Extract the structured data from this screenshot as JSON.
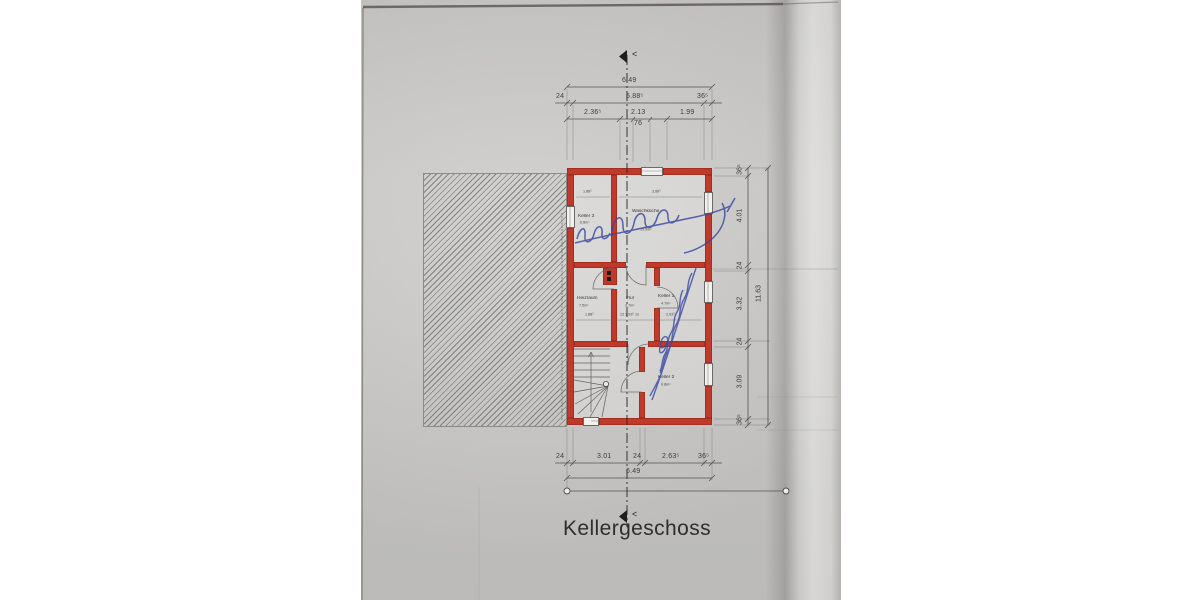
{
  "document": {
    "type": "scanned basement floor plan",
    "title": "Kellergeschoss"
  },
  "rooms": [
    {
      "name": "Keller 3",
      "area": "6.8m²",
      "width_dim": "1.88⁵"
    },
    {
      "name": "Waschküche",
      "area": "15.5m²",
      "width_dim": "3.88⁵"
    },
    {
      "name": "Heizraum",
      "area": "7.5m²",
      "width_dim": "1.88⁵"
    },
    {
      "name": "Flur",
      "area": "3.7m²",
      "width_dim": "12 1.93⁵ 12"
    },
    {
      "name": "Keller 1",
      "area": "4.7m²",
      "width_dim": "2.63⁵"
    },
    {
      "name": "Keller 2",
      "area": "9.8m²",
      "width_dim": ""
    }
  ],
  "dims_top": {
    "overall": "6.49",
    "chain2": [
      "24",
      "5.88⁵",
      "36⁵"
    ],
    "chain3": [
      "2.36⁵",
      "2.13",
      "1.99"
    ],
    "door_width": "76"
  },
  "dims_right": {
    "chain": [
      "36⁵",
      "4.01",
      "24",
      "3.32",
      "24",
      "3.09",
      "36⁵"
    ],
    "overall": "11.63"
  },
  "dims_bottom": {
    "chain": [
      "24",
      "3.01",
      "24",
      "2.63⁵",
      "36⁵"
    ],
    "overall": "6.49"
  },
  "section_marker": "<",
  "annotations": {
    "handwritten_ink_color": "#37479f",
    "handwritten_note_top": "illegible blue cursive handwriting",
    "handwritten_note_right": "illegible blue cursive handwriting (vertical)",
    "left_boundary_microtext": "illegible micro text along left wall"
  },
  "colors": {
    "wall_red": "#c03a2b",
    "paper_gray": "#c8c7c5",
    "ink_blue": "#37479f"
  }
}
